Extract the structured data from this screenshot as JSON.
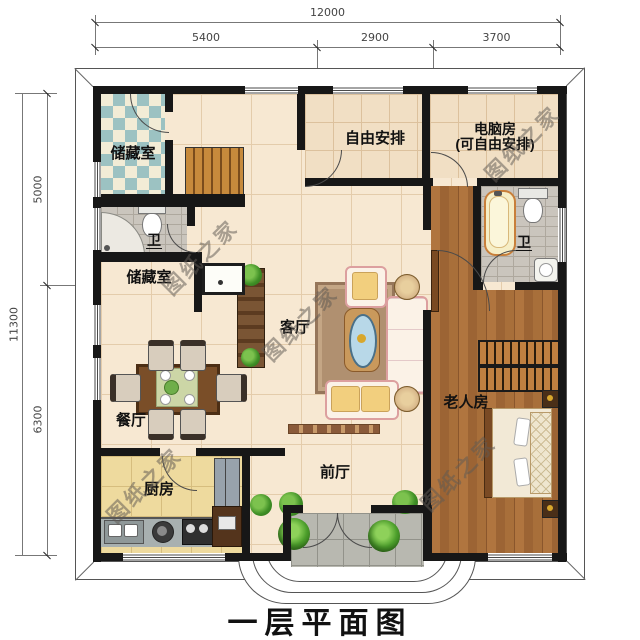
{
  "title": "一层平面图",
  "watermark_text": "图纸之家",
  "dimensions": {
    "top": {
      "total": "12000",
      "segments": [
        "5400",
        "2900",
        "3700"
      ]
    },
    "left": {
      "total": "11300",
      "segments": [
        "5000",
        "6300"
      ]
    }
  },
  "rooms": {
    "storage_top": {
      "label": "储藏室"
    },
    "free_room": {
      "label": "自由安排"
    },
    "computer_room": {
      "label_line1": "电脑房",
      "label_line2": "(可自由安排)"
    },
    "bath_left": {
      "label": "卫"
    },
    "bath_right": {
      "label": "卫"
    },
    "storage_mid": {
      "label": "储藏室"
    },
    "living_room": {
      "label": "客厅"
    },
    "dining_room": {
      "label": "餐厅"
    },
    "elder_room": {
      "label": "老人房"
    },
    "kitchen": {
      "label": "厨房"
    },
    "front_hall": {
      "label": "前厅"
    }
  },
  "colors": {
    "wall": "#171717",
    "floor_cream": "#f7e8d2",
    "floor_beige": "#f1dfc4",
    "checker_teal": "#9cc2c2",
    "wood_floor": "#a86f3a",
    "stair_wood": "#c78a3c",
    "bath_tile": "#cac5bd",
    "kitchen_tile": "#eeda9e",
    "porch_tile": "#b8b8b0",
    "sofa_outline": "#dc9f9f",
    "plant_green": "#4da02c"
  }
}
